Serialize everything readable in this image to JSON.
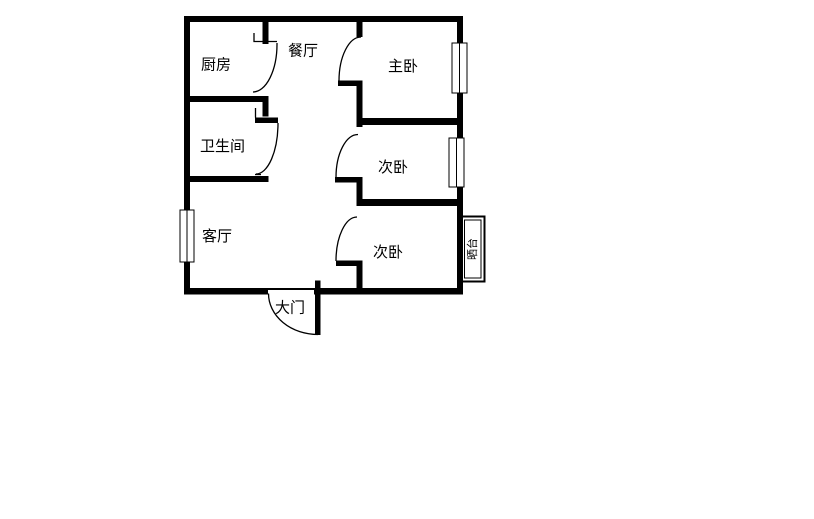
{
  "page": {
    "background_color": "#ffffff",
    "line_color": "#000000",
    "description": "apartment floor plan drawing"
  },
  "floor_plan": {
    "rooms": [
      {
        "id": "kitchen",
        "label": "厨房"
      },
      {
        "id": "dining-room",
        "label": "餐厅"
      },
      {
        "id": "master-bedroom",
        "label": "主卧"
      },
      {
        "id": "bathroom",
        "label": "卫生间"
      },
      {
        "id": "second-bedroom-upper",
        "label": "次卧"
      },
      {
        "id": "living-room",
        "label": "客厅"
      },
      {
        "id": "second-bedroom-lower",
        "label": "次卧"
      },
      {
        "id": "balcony",
        "label": "晒台"
      },
      {
        "id": "entrance",
        "label": "大门"
      }
    ]
  }
}
